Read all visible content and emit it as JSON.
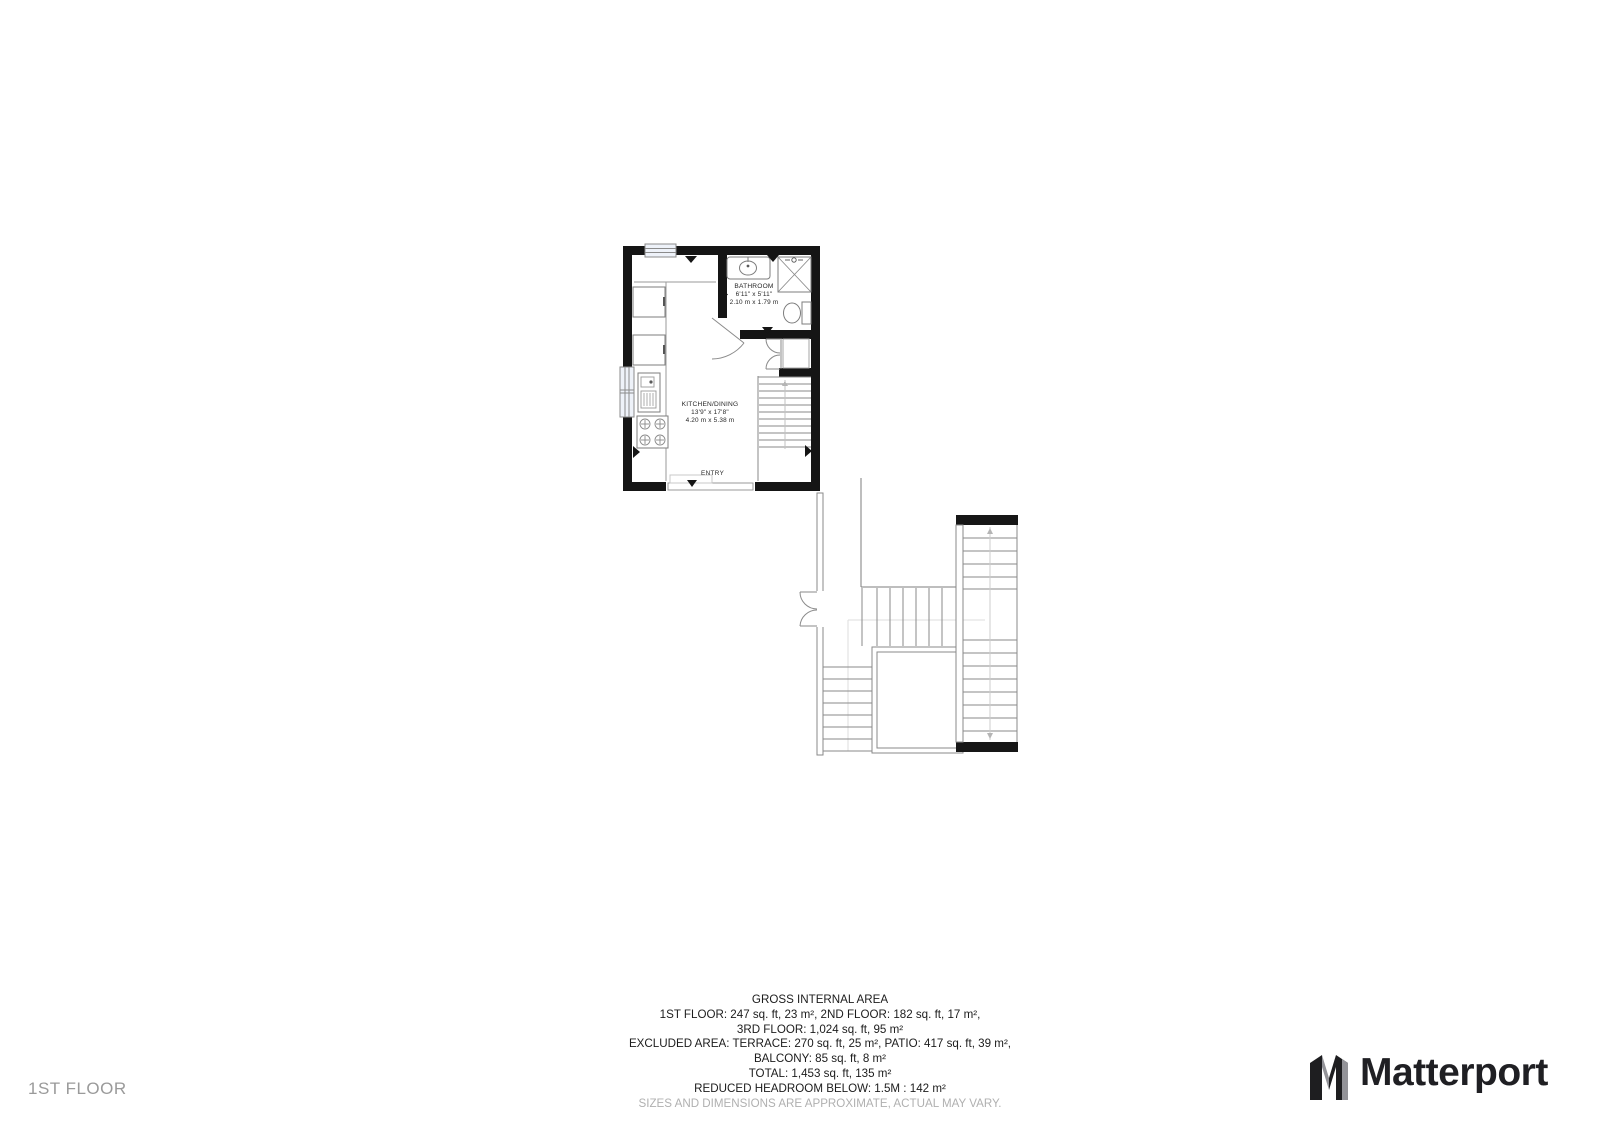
{
  "rooms": {
    "kitchen": {
      "name": "KITCHEN/DINING",
      "imperial": "13'9\" x 17'8\"",
      "metric": "4.20 m x 5.38 m"
    },
    "bathroom": {
      "name": "BATHROOM",
      "imperial": "6'11\" x 5'11\"",
      "metric": "2.10 m x 1.79 m"
    },
    "entry": {
      "name": "ENTRY"
    }
  },
  "summary": {
    "lines": [
      "GROSS INTERNAL AREA",
      "1ST FLOOR: 247 sq. ft, 23 m², 2ND FLOOR: 182 sq. ft, 17 m²,",
      "3RD FLOOR: 1,024 sq. ft, 95 m²",
      "EXCLUDED AREA: TERRACE: 270 sq. ft, 25 m², PATIO: 417 sq. ft, 39 m²,",
      "BALCONY: 85 sq. ft, 8 m²",
      "TOTAL: 1,453 sq. ft, 135 m²",
      "REDUCED HEADROOM BELOW: 1.5M : 142 m²"
    ],
    "disclaimer": "SIZES AND DIMENSIONS ARE APPROXIMATE, ACTUAL MAY VARY."
  },
  "footer": {
    "floor_label": "1ST FLOOR",
    "brand_name": "Matterport"
  },
  "colors": {
    "wall": "#151515",
    "fixture_line": "#8a8a8a",
    "faint_line": "#dedede",
    "window_fill": "#eef2f9",
    "muted_text": "#9a9a9a",
    "text": "#1c1c1c",
    "disclaimer_text": "#b0b0b0"
  }
}
